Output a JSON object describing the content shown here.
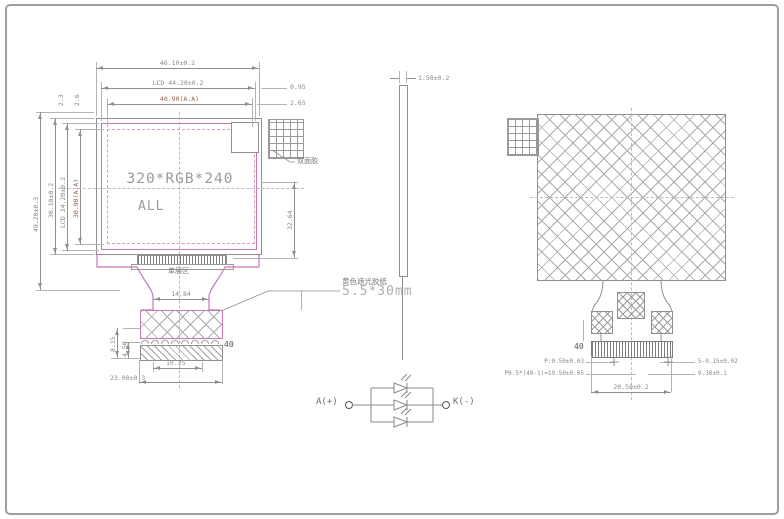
{
  "front_view": {
    "screen_line1": "320*RGB*240",
    "screen_line2": "ALL",
    "top_dims": {
      "outline": "46.10±0.2",
      "lcd": "LCD 44.20±0.2",
      "active_area": "40.90(A.A)",
      "edge_offset1": "0.95",
      "edge_offset2": "2.65"
    },
    "left_dims": {
      "overall": "49.20±0.3",
      "outline": "36.10±0.2",
      "lcd": "LCD 34.20±0.2",
      "active_area": "30.90(A.A)",
      "edge_offset1": "2.3",
      "edge_offset2": "2.6"
    },
    "right_dim": "32.64",
    "bottom_dims": {
      "neck_width": "14.84",
      "connector_width": "10.25",
      "tail_width": "23.00±0.3",
      "stiffener_total": "8.15",
      "stiffener_lower": "4.50"
    },
    "labels": {
      "single_layer_zone": "单层区",
      "tape_name": "黄色遮光胶纸",
      "tape_size": "5.5*30mm",
      "adhesive_pad": "双面胶",
      "pin_count": "40"
    }
  },
  "side_view": {
    "thickness": "1.50±0.2"
  },
  "back_view": {
    "pin_count": "40",
    "pitch": "P:0.50±0.03",
    "pitch_total": "P0.5*(40-1)=19.50±0.05",
    "finger_thickness": "5-0.15±0.02",
    "finger_width": "0.30±0.1",
    "connector_width": "20.50±0.2"
  },
  "circuit": {
    "anode_label": "A(+)",
    "cathode_label": "K(-)"
  },
  "colors": {
    "line_gray": "#8f8f8f",
    "outline_pink": "#c878b4",
    "dim_text": "#8a8a8a",
    "aa_text": "#96604f"
  }
}
